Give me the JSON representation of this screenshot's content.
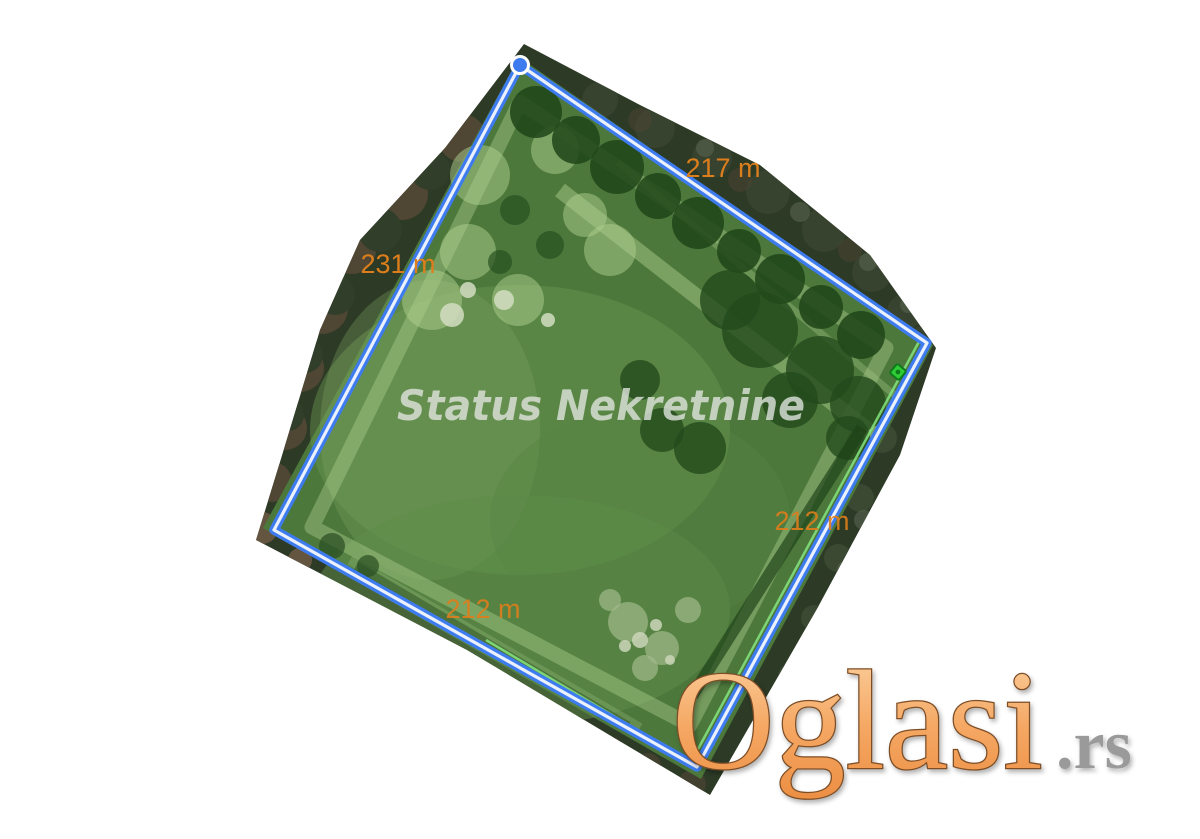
{
  "page": {
    "background": "#FFFFFF"
  },
  "photo": {
    "watermark_text": "Status Nekretnine",
    "watermark_color": "#E3E7E1",
    "measurements": [
      {
        "edge": "top-right",
        "text": "217 m"
      },
      {
        "edge": "top-left",
        "text": "231 m"
      },
      {
        "edge": "bottom-right",
        "text": "212 m"
      },
      {
        "edge": "bottom-left",
        "text": "212 m"
      }
    ],
    "label_color": "#DD7E1C",
    "measure_line": {
      "blue": "#3D7BEE",
      "core": "#EAF1FD"
    },
    "vertex_marker_color": "#3D7BEE",
    "parcel_marker_color": "#2FCC35",
    "parcel_marker_outline": "#0E7A1B",
    "parcel_boundary_green": "#86E57F"
  },
  "logo": {
    "main_text": "Oglasi",
    "suffix_text": ".rs",
    "gradient": [
      "#FBD4A4",
      "#F5A763",
      "#EC8F43"
    ],
    "outline_color": "#7D4E26",
    "suffix_color": "#9A9A9A"
  }
}
